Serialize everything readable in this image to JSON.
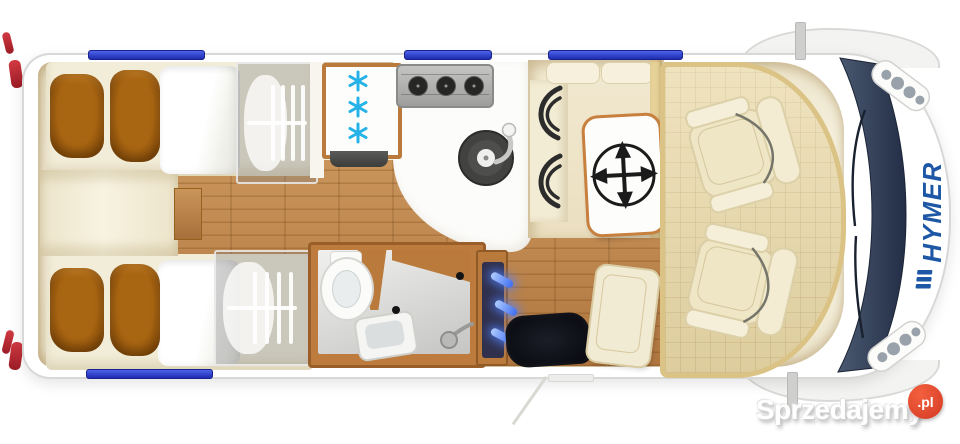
{
  "branding": {
    "vehicle_logo": "HYMER",
    "logo_color": "#1d57a5"
  },
  "watermark": {
    "site_name": "Sprzedajemy",
    "domain_suffix": ".pl",
    "badge_color": "#e2482e",
    "text_color": "#ffffff"
  },
  "floorplan": {
    "type": "motorhome-top-view-floor-plan",
    "areas": [
      {
        "name": "rear-bedroom",
        "features": [
          "twin-single-beds",
          "brown-pillows",
          "white-duvets",
          "two-wardrobes-with-hangers"
        ]
      },
      {
        "name": "kitchen",
        "features": [
          "fridge-freezer",
          "three-burner-hob",
          "round-sink",
          "worktop"
        ]
      },
      {
        "name": "bathroom",
        "features": [
          "toilet",
          "washbasin",
          "shower-head"
        ]
      },
      {
        "name": "entrance",
        "features": [
          "dark-door-mat",
          "blue-illuminated-steps",
          "open-door-swing"
        ]
      },
      {
        "name": "dinette",
        "features": [
          "side-bench",
          "wall-cushions",
          "movable-table"
        ]
      },
      {
        "name": "cab",
        "features": [
          "swivel-driver-seat",
          "swivel-passenger-seat",
          "windshield",
          "headlight-clusters",
          "side-mirrors"
        ]
      }
    ],
    "icons": {
      "freezer-icon": "three cyan snowflakes",
      "table-mobility-icon": "four-way arrow compass",
      "roof-windows": "blue strips on body walls"
    },
    "colors": {
      "floor_wood": "#bf8a4e",
      "upholstery_cream": "#f0e7cc",
      "pillow_brown": "#9c5a10",
      "window_blue": "#2d3fd0",
      "snowflake_cyan": "#29b2e4",
      "windshield_slate": "#3a4659",
      "led_blue": "#4d7dff",
      "frame_wood": "#c07a38",
      "tail_lamp_red": "#c0303a"
    }
  }
}
